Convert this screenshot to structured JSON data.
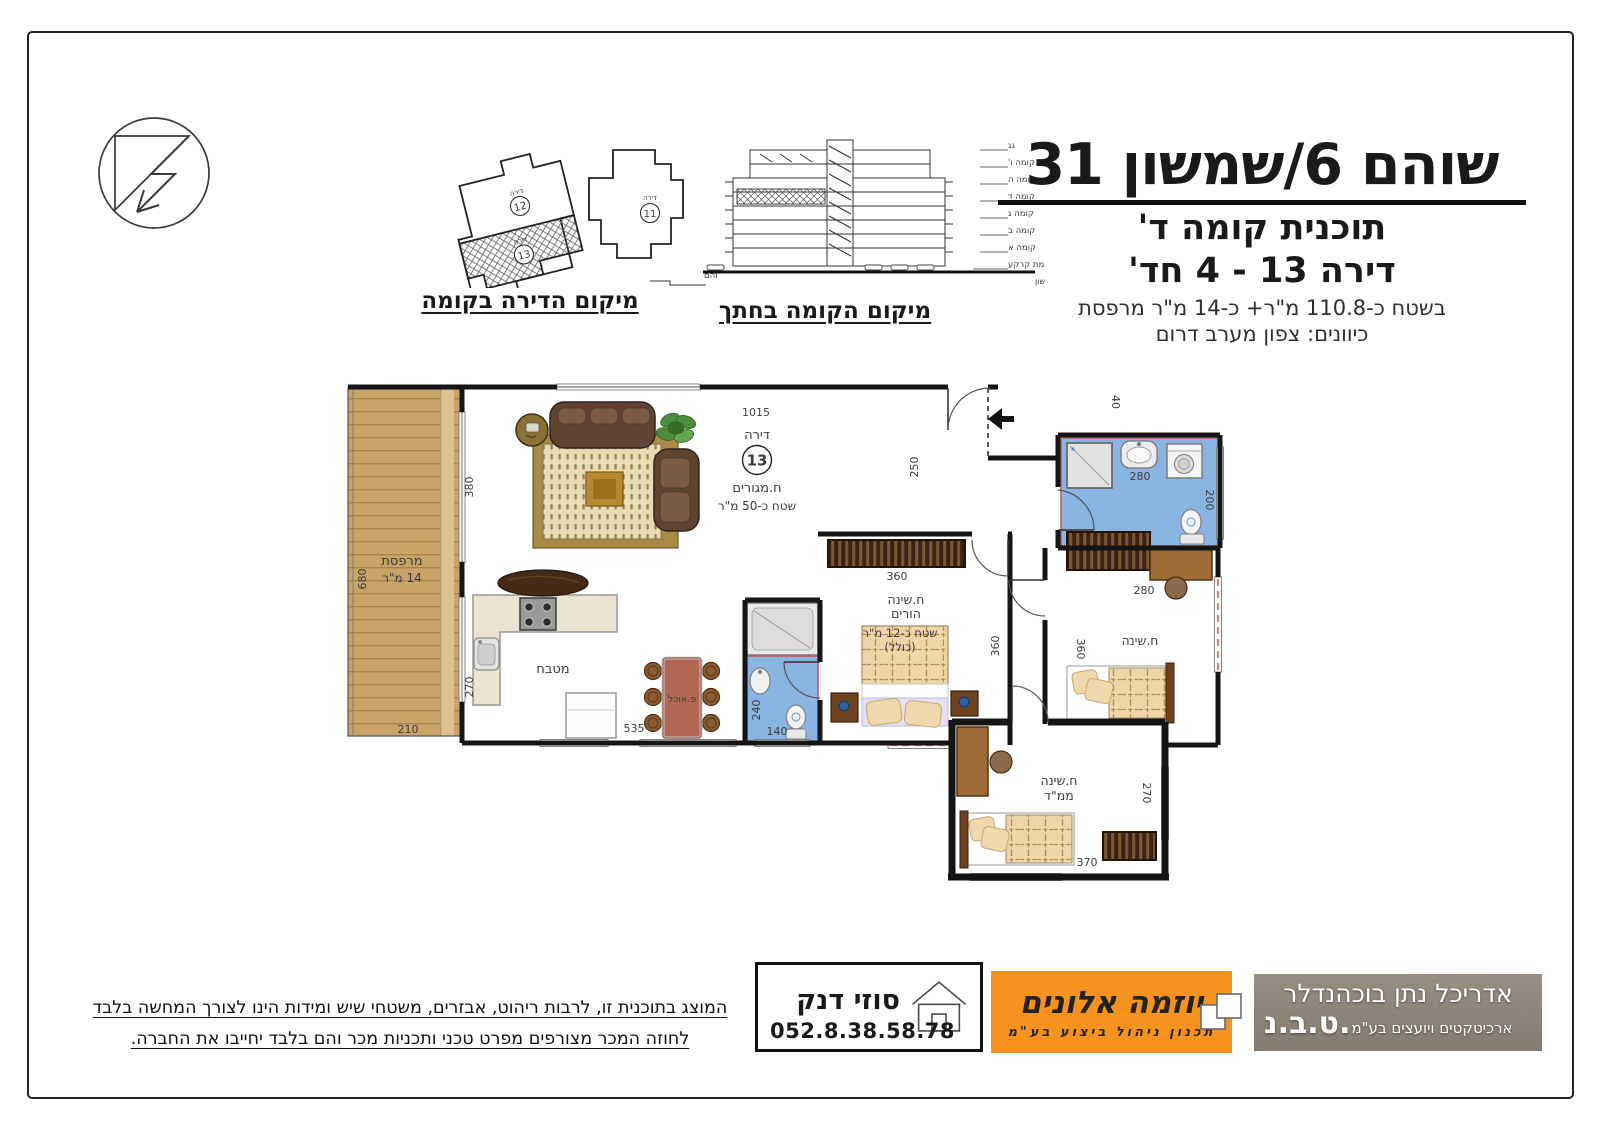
{
  "header": {
    "title": "שוהם 6/שמשון 31",
    "plan_line": "תוכנית קומה ד'",
    "apt_line": "דירה 13 - 4 חד'",
    "area_line": "בשטח כ-110.8 מ\"ר+  כ-14 מ\"ר מרפסת",
    "directions_line": "כיוונים: צפון מערב דרום"
  },
  "location_diagram": {
    "caption": "מיקום הדירה בקומה",
    "street": "רח' שוהם",
    "apartment_word": "דירה",
    "apt11": "11",
    "apt12": "12",
    "apt13": "13"
  },
  "section_diagram": {
    "caption": "מיקום הקומה בחתך",
    "street": "רח' שמשון",
    "floors": [
      "גג",
      "קומה ו'",
      "קומה ה",
      "קומה ד",
      "קומה ג",
      "קומה ב",
      "קומה א",
      "קומת קרקע"
    ]
  },
  "plan": {
    "apartment_word": "דירה",
    "apartment_number": "13",
    "rooms": {
      "living_name": "ח.מגורים",
      "living_area": "שטח כ-50 מ\"ר",
      "balcony_name": "מרפסת",
      "balcony_area": "14 מ\"ר",
      "kitchen": "מטבח",
      "dining": "פ.אוכל",
      "parents_name": "ח.שינה",
      "parents_sub": "הורים",
      "parents_area": "שטח כ-12 מ\"ר",
      "parents_area2": "(כולל)",
      "bedroom": "ח.שינה",
      "mamad_name": "ח.שינה",
      "mamad_sub": "ממ\"ד"
    },
    "dims": {
      "top_width": "1015",
      "entry_hall": "250",
      "living_side": "380",
      "balcony_height": "680",
      "balcony_width": "210",
      "kitchen_side": "270",
      "kitchen_width": "535",
      "bath_width": "140",
      "bath_height": "240",
      "parents_closet": "360",
      "parents_side": "360",
      "bedroom_side": "360",
      "bath2_width": "280",
      "bath2_height": "200",
      "desk_width": "280",
      "mamad_width": "370",
      "mamad_height": "270",
      "entry_niche": "40"
    }
  },
  "footer": {
    "disclaimer_line1": "המוצג בתוכנית זו, לרבות ריהוט, אבזרים, משטחי שיש ומידות הינו לצורך המחשה בלבד",
    "disclaimer_line2": "לחוזה המכר מצורפים מפרט טכני ותכניות מכר והם בלבד יחייבו את החברה.",
    "agent": {
      "name": "סוזי דנק",
      "phone": "052.8.38.58.78"
    },
    "company": {
      "name": "יוזמה אלונים",
      "subtitle": "תכנון ניהול ביצוע בע\"מ"
    },
    "architect": {
      "title_line": "אדריכל נתן בוכהנדלר",
      "abbr": "ט.ב.נ.",
      "subtitle": "ארכיטקטים ויועצים בע\"מ"
    }
  },
  "colors": {
    "accent_orange": "#f6921e",
    "bathroom_blue": "#8ab5e2",
    "balcony_wood": "#c9a468",
    "wall_black": "#151515",
    "window_red_dash": "#d97f7f",
    "architect_gray": "#8b8478"
  }
}
